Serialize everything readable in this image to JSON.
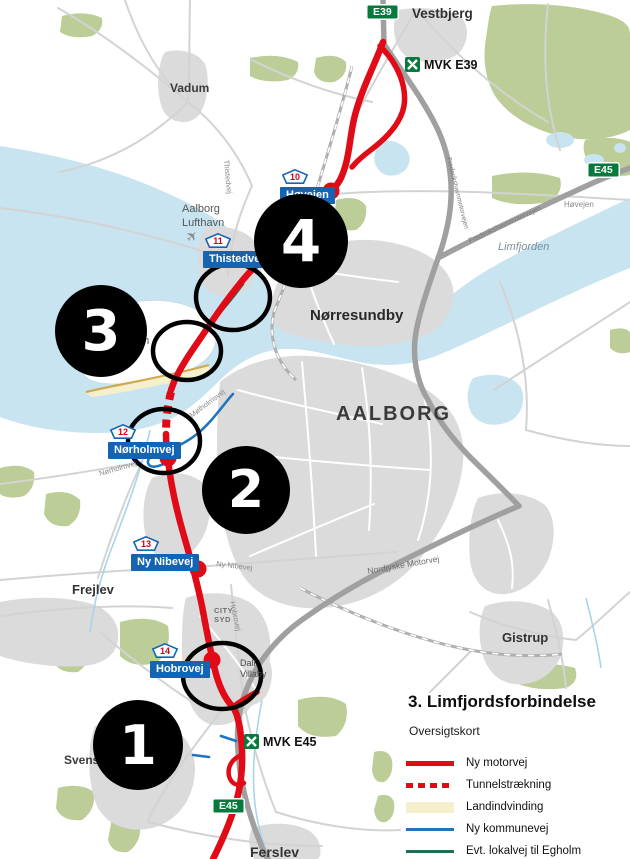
{
  "legend": {
    "title": "3. Limfjordsforbindelse",
    "subtitle": "Oversigtskort",
    "items": [
      {
        "label": "Ny motorvej",
        "style": "solid-red"
      },
      {
        "label": "Tunnelstrækning",
        "style": "dashed-red"
      },
      {
        "label": "Landindvinding",
        "style": "fill-cream"
      },
      {
        "label": "Ny kommunevej",
        "style": "solid-blue"
      },
      {
        "label": "Evt. lokalvej til Egholm",
        "style": "solid-green"
      }
    ]
  },
  "markers": {
    "m1": "1",
    "m2": "2",
    "m3": "3",
    "m4": "4"
  },
  "exits": [
    {
      "number": "10",
      "name": "Høvejen"
    },
    {
      "number": "11",
      "name": "Thistedvej"
    },
    {
      "number": "12",
      "name": "Nørholmvej"
    },
    {
      "number": "13",
      "name": "Ny Nibevej"
    },
    {
      "number": "14",
      "name": "Hobrovej"
    }
  ],
  "route_signs": {
    "e39_top": "E39",
    "e45_right": "E45",
    "e45_bottom": "E45"
  },
  "junction_labels": {
    "mvk_e39": "MVK E39",
    "mvk_e45": "MVK E45"
  },
  "places": {
    "vestbjerg": "Vestbjerg",
    "vadum": "Vadum",
    "airport_line1": "Aalborg",
    "airport_line2": "Lufthavn",
    "norresundby": "Nørresundby",
    "aalborg": "AALBORG",
    "egholm": "Egholm",
    "limfjorden": "Limfjorden",
    "frejlev": "Frejlev",
    "gistrup": "Gistrup",
    "ferslev": "Ferslev",
    "svenstrup": "Svenstrup",
    "dall_line1": "Dall",
    "dall_line2": "Villaby",
    "city_syd_line1": "CITY",
    "city_syd_line2": "SYD"
  },
  "roads": {
    "hovejen": "Høvejen",
    "thistedvej": "Thistedvej",
    "norholmvej": "Nørholmvej",
    "molholmsvej": "Mølholmsvej",
    "ny_nibevej": "Ny Nibevej",
    "hobrovej": "Hobrovej",
    "nordjyske": "Nordjyske Motorvej",
    "frederikshavn": "Frederikshavnmotorvejen"
  },
  "icons": {
    "airplane": "✈"
  },
  "colors": {
    "new_motorway_red": "#e10a17",
    "kommunevej_blue": "#1e74bd",
    "lokalvej_green": "#1f6f52",
    "landindvinding_cream": "#f6efcb",
    "water_blue": "#c9e4f1",
    "exit_sign_blue": "#1464b4",
    "e_sign_green": "#067a3d"
  }
}
